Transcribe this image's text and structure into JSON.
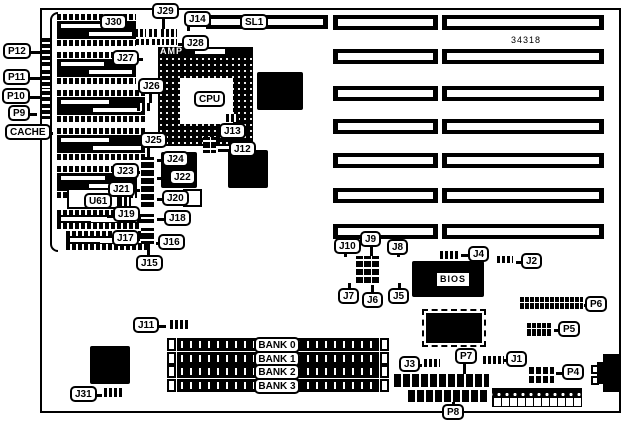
{
  "diagram": {
    "part_number": "34318",
    "board": {
      "x": 40,
      "y": 8,
      "w": 581,
      "h": 405
    },
    "callouts": [
      {
        "text": "J30",
        "x": 100,
        "y": 14,
        "tail": "right",
        "len": 7
      },
      {
        "text": "J29",
        "x": 152,
        "y": 3
      },
      {
        "text": "J14",
        "x": 184,
        "y": 11
      },
      {
        "text": "SL1",
        "x": 240,
        "y": 14
      },
      {
        "text": "J28",
        "x": 182,
        "y": 35,
        "tail": "left",
        "len": 6
      },
      {
        "text": "J27",
        "x": 112,
        "y": 50,
        "tail": "right",
        "len": 6
      },
      {
        "text": "P12",
        "x": 3,
        "y": 43,
        "tail": "right",
        "len": 12
      },
      {
        "text": "P11",
        "x": 3,
        "y": 69,
        "tail": "right",
        "len": 12
      },
      {
        "text": "P10",
        "x": 2,
        "y": 88,
        "tail": "right",
        "len": 13
      },
      {
        "text": "P9",
        "x": 8,
        "y": 105,
        "tail": "right",
        "len": 9
      },
      {
        "text": "CACHE",
        "x": 5,
        "y": 124,
        "tail": "right",
        "len": 4
      },
      {
        "text": "J26",
        "x": 138,
        "y": 78
      },
      {
        "text": "CPU",
        "x": 194,
        "y": 91
      },
      {
        "text": "J13",
        "x": 219,
        "y": 123
      },
      {
        "text": "J12",
        "x": 229,
        "y": 141,
        "tail": "left",
        "len": 13
      },
      {
        "text": "J25",
        "x": 140,
        "y": 132
      },
      {
        "text": "J24",
        "x": 162,
        "y": 151,
        "tail": "left",
        "len": 7
      },
      {
        "text": "J23",
        "x": 112,
        "y": 163,
        "tail": "right",
        "len": 3
      },
      {
        "text": "J22",
        "x": 169,
        "y": 169,
        "tail": "left",
        "len": 14
      },
      {
        "text": "J21",
        "x": 108,
        "y": 181,
        "tail": "right",
        "len": 7
      },
      {
        "text": "J20",
        "x": 162,
        "y": 190,
        "tail": "left",
        "len": 7
      },
      {
        "text": "U61",
        "x": 84,
        "y": 193
      },
      {
        "text": "J19",
        "x": 113,
        "y": 206,
        "tail": "right",
        "len": 3
      },
      {
        "text": "J18",
        "x": 164,
        "y": 210,
        "tail": "left",
        "len": 9
      },
      {
        "text": "J17",
        "x": 112,
        "y": 230,
        "tail": "right",
        "len": 3
      },
      {
        "text": "J16",
        "x": 158,
        "y": 234,
        "tail": "left",
        "len": 4
      },
      {
        "text": "J15",
        "x": 136,
        "y": 255
      },
      {
        "text": "J11",
        "x": 133,
        "y": 317,
        "tail": "right",
        "len": 9
      },
      {
        "text": "J31",
        "x": 70,
        "y": 386,
        "tail": "right",
        "len": 7
      },
      {
        "text": "J10",
        "x": 334,
        "y": 238
      },
      {
        "text": "J9",
        "x": 360,
        "y": 231
      },
      {
        "text": "J8",
        "x": 387,
        "y": 239
      },
      {
        "text": "J7",
        "x": 338,
        "y": 288
      },
      {
        "text": "J6",
        "x": 362,
        "y": 292
      },
      {
        "text": "J5",
        "x": 388,
        "y": 288
      },
      {
        "text": "J4",
        "x": 468,
        "y": 246,
        "tail": "left",
        "len": 9
      },
      {
        "text": "J2",
        "x": 521,
        "y": 253,
        "tail": "left",
        "len": 7
      },
      {
        "text": "BIOS",
        "x": 436,
        "y": 272,
        "style": "square"
      },
      {
        "text": "P6",
        "x": 585,
        "y": 296,
        "tail": "left",
        "len": 3
      },
      {
        "text": "P5",
        "x": 558,
        "y": 321,
        "tail": "left",
        "len": 6
      },
      {
        "text": "J3",
        "x": 399,
        "y": 356,
        "tail": "right",
        "len": 4
      },
      {
        "text": "P7",
        "x": 455,
        "y": 348
      },
      {
        "text": "J1",
        "x": 506,
        "y": 351,
        "tail": "left",
        "len": 4
      },
      {
        "text": "P4",
        "x": 562,
        "y": 364,
        "tail": "left",
        "len": 8
      },
      {
        "text": "P8",
        "x": 442,
        "y": 404
      }
    ],
    "leaders": [
      {
        "x": 162,
        "y": 18,
        "w": 3,
        "h": 12
      },
      {
        "x": 149,
        "y": 93,
        "w": 3,
        "h": 11
      },
      {
        "x": 147,
        "y": 147,
        "w": 3,
        "h": 11
      },
      {
        "x": 147,
        "y": 244,
        "w": 3,
        "h": 12
      },
      {
        "x": 344,
        "y": 252,
        "w": 3,
        "h": 5
      },
      {
        "x": 370,
        "y": 246,
        "w": 3,
        "h": 11
      },
      {
        "x": 397,
        "y": 253,
        "w": 3,
        "h": 4
      },
      {
        "x": 348,
        "y": 283,
        "w": 3,
        "h": 6
      },
      {
        "x": 371,
        "y": 285,
        "w": 3,
        "h": 8
      },
      {
        "x": 398,
        "y": 283,
        "w": 3,
        "h": 6
      },
      {
        "x": 463,
        "y": 363,
        "w": 3,
        "h": 12
      },
      {
        "x": 452,
        "y": 391,
        "w": 3,
        "h": 14
      },
      {
        "x": 187,
        "y": 26,
        "w": 3,
        "h": 5
      }
    ],
    "chips": [
      {
        "name": "chip-right-of-cpu",
        "x": 257,
        "y": 72,
        "w": 46,
        "h": 38,
        "kind": "flat"
      },
      {
        "name": "chip-mid-right",
        "x": 228,
        "y": 150,
        "w": 40,
        "h": 38,
        "kind": "flat"
      },
      {
        "name": "chip-mid-left",
        "x": 161,
        "y": 152,
        "w": 36,
        "h": 36,
        "kind": "flat"
      },
      {
        "name": "chip-bottom-left",
        "x": 90,
        "y": 346,
        "w": 40,
        "h": 38,
        "kind": "flat"
      },
      {
        "name": "bios-chip",
        "x": 412,
        "y": 261,
        "w": 72,
        "h": 36,
        "kind": "flat"
      },
      {
        "name": "chipset-qfp",
        "x": 426,
        "y": 313,
        "w": 56,
        "h": 30,
        "kind": "qfp"
      }
    ],
    "white_boxes": [
      {
        "name": "u61-chip-body",
        "x": 67,
        "y": 188,
        "w": 52,
        "h": 21
      },
      {
        "name": "small-component-box",
        "x": 183,
        "y": 189,
        "w": 19,
        "h": 18
      },
      {
        "name": "kbd-pin-upper",
        "x": 591,
        "y": 365,
        "w": 8,
        "h": 9
      },
      {
        "name": "kbd-pin-lower",
        "x": 591,
        "y": 376,
        "w": 8,
        "h": 9
      }
    ],
    "jumpers": [
      {
        "name": "j30-pins",
        "x": 135,
        "y": 29,
        "w": 11,
        "h": 8,
        "kind": "h"
      },
      {
        "name": "j29-pins-a",
        "x": 149,
        "y": 29,
        "w": 9,
        "h": 8,
        "kind": "h"
      },
      {
        "name": "j29-pins-b",
        "x": 161,
        "y": 29,
        "w": 8,
        "h": 8,
        "kind": "h"
      },
      {
        "name": "j29-pins-c",
        "x": 171,
        "y": 29,
        "w": 6,
        "h": 8,
        "kind": "h"
      },
      {
        "name": "j27-pins",
        "x": 136,
        "y": 39,
        "w": 13,
        "h": 6,
        "kind": "h"
      },
      {
        "name": "j28-pins-a",
        "x": 152,
        "y": 39,
        "w": 12,
        "h": 6,
        "kind": "h"
      },
      {
        "name": "j28-pins-b",
        "x": 166,
        "y": 39,
        "w": 11,
        "h": 6,
        "kind": "h"
      },
      {
        "name": "j26-jumper",
        "x": 137,
        "y": 103,
        "w": 15,
        "h": 8,
        "kind": "h"
      },
      {
        "name": "j13-pins",
        "x": 226,
        "y": 114,
        "w": 13,
        "h": 8,
        "kind": "h"
      },
      {
        "name": "j12-jumper",
        "x": 203,
        "y": 137,
        "w": 13,
        "h": 16,
        "kind": "grid"
      },
      {
        "name": "jumper-strip-main",
        "x": 141,
        "y": 157,
        "w": 13,
        "h": 50,
        "kind": "v"
      },
      {
        "name": "j18-jumper",
        "x": 141,
        "y": 214,
        "w": 13,
        "h": 9,
        "kind": "v"
      },
      {
        "name": "j16-jumper",
        "x": 141,
        "y": 228,
        "w": 13,
        "h": 16,
        "kind": "v"
      },
      {
        "name": "u61-side-pins",
        "x": 119,
        "y": 197,
        "w": 12,
        "h": 10,
        "kind": "h"
      },
      {
        "name": "j5-j10-block",
        "x": 356,
        "y": 256,
        "w": 24,
        "h": 29,
        "kind": "grid"
      },
      {
        "name": "j4-jumper",
        "x": 440,
        "y": 251,
        "w": 19,
        "h": 8,
        "kind": "h"
      },
      {
        "name": "j2-jumper",
        "x": 497,
        "y": 256,
        "w": 16,
        "h": 7,
        "kind": "h"
      },
      {
        "name": "j1-jumper",
        "x": 483,
        "y": 356,
        "w": 21,
        "h": 8,
        "kind": "h"
      },
      {
        "name": "j3-jumper",
        "x": 424,
        "y": 359,
        "w": 16,
        "h": 8,
        "kind": "h"
      },
      {
        "name": "j11-jumper",
        "x": 170,
        "y": 320,
        "w": 20,
        "h": 9,
        "kind": "h"
      },
      {
        "name": "j31-jumper",
        "x": 104,
        "y": 388,
        "w": 18,
        "h": 9,
        "kind": "h"
      }
    ],
    "headers": [
      {
        "name": "p6-header",
        "x": 520,
        "y": 297,
        "w": 63,
        "h": 12,
        "kind": "ticks"
      },
      {
        "name": "p5-header",
        "x": 527,
        "y": 323,
        "w": 25,
        "h": 13,
        "kind": "ticks"
      },
      {
        "name": "p4-header",
        "x": 529,
        "y": 367,
        "w": 25,
        "h": 16,
        "kind": "grid"
      },
      {
        "name": "p7-connector",
        "x": 394,
        "y": 374,
        "w": 95,
        "h": 13,
        "kind": "bar"
      },
      {
        "name": "p8-connector",
        "x": 408,
        "y": 390,
        "w": 81,
        "h": 12,
        "kind": "bar"
      },
      {
        "name": "power-connector-pins",
        "x": 492,
        "y": 388,
        "w": 90,
        "h": 9,
        "kind": "dots"
      },
      {
        "name": "power-connector-sockets",
        "x": 492,
        "y": 397,
        "w": 90,
        "h": 10,
        "kind": "cells"
      }
    ],
    "edge_pins": [
      {
        "name": "p12-edge-connector",
        "x": 42,
        "y": 38,
        "w": 8,
        "h": 29
      },
      {
        "name": "p11-edge-connector",
        "x": 42,
        "y": 70,
        "w": 8,
        "h": 19
      },
      {
        "name": "p10-edge-connector",
        "x": 42,
        "y": 91,
        "w": 8,
        "h": 11
      },
      {
        "name": "p9-edge-connector",
        "x": 42,
        "y": 104,
        "w": 8,
        "h": 15
      }
    ],
    "cache_chips": [
      {
        "x": 57,
        "y": 14,
        "w": 79,
        "thin": false
      },
      {
        "x": 57,
        "y": 52,
        "w": 79,
        "thin": false
      },
      {
        "x": 57,
        "y": 90,
        "w": 88,
        "thin": false
      },
      {
        "x": 57,
        "y": 128,
        "w": 88,
        "thin": false
      },
      {
        "x": 57,
        "y": 166,
        "w": 80,
        "thin": false
      },
      {
        "x": 57,
        "y": 210,
        "w": 84,
        "thin": true
      },
      {
        "x": 66,
        "y": 231,
        "w": 84,
        "thin": true
      }
    ],
    "isa": {
      "x1": 333,
      "w1": 105,
      "x2": 442,
      "w2": 162,
      "h": 15,
      "rows": [
        15,
        49,
        86,
        119,
        153,
        188,
        224
      ]
    },
    "sl1_slot": {
      "x": 206,
      "y": 15,
      "w": 122,
      "h": 14
    },
    "cpu_socket": {
      "x": 158,
      "y": 56,
      "w": 95,
      "h": 90,
      "core_x": 180,
      "core_y": 78,
      "core_w": 53,
      "core_h": 46,
      "amp_label": "AMP",
      "amp_x": 158,
      "amp_y": 47,
      "amp_w": 95,
      "amp_h": 9
    },
    "simm": {
      "x": 167,
      "bar_end": 379,
      "clip_w": 9,
      "h": 13,
      "rows": [
        338,
        352,
        365,
        379
      ],
      "label_x": 254,
      "label_w": 46,
      "banks": [
        "BANK 0",
        "BANK 1",
        "BANK 2",
        "BANK 3"
      ]
    },
    "kbd": {
      "main_x": 603,
      "main_y": 354,
      "main_w": 16,
      "main_h": 38,
      "tab_x": 597,
      "tab_y": 362,
      "tab_w": 7,
      "tab_h": 22
    },
    "cache_brace": {
      "x": 50,
      "y": 12,
      "w": 8,
      "h": 240
    },
    "part_number_pos": {
      "x": 511,
      "y": 35
    }
  }
}
